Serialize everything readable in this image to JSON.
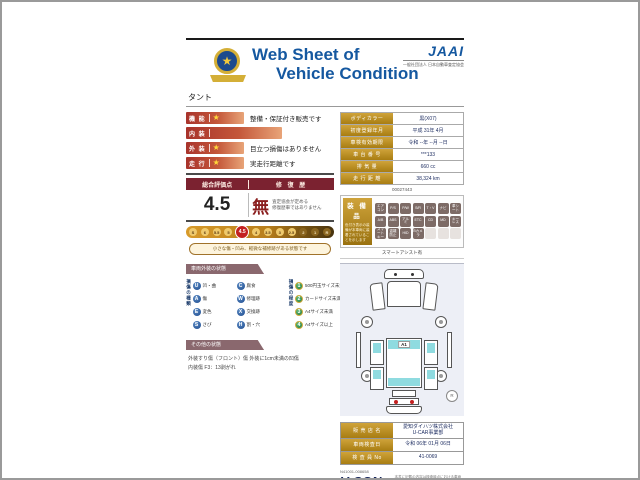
{
  "header": {
    "title_line1": "Web Sheet of",
    "title_line2": "Vehicle Condition",
    "brand": "JAAI",
    "brand_sub": "一般社団法人 日本自動車査定協会",
    "model": "タント"
  },
  "ratings": [
    {
      "label": "機 能",
      "star": true,
      "wide": false,
      "desc": "整備・保証付き販売です"
    },
    {
      "label": "内 装",
      "star": false,
      "wide": true,
      "desc": ""
    },
    {
      "label": "外 装",
      "star": true,
      "wide": false,
      "desc": "目立つ損傷はありません"
    },
    {
      "label": "走 行",
      "star": true,
      "wide": false,
      "desc": "実走行距離です"
    }
  ],
  "score": {
    "header_left": "総合評価点",
    "header_right": "修 復 歴",
    "value": "4.5",
    "repair": "無",
    "repair_note1": "査定協会が定める",
    "repair_note2": "修復歴車ではありません",
    "scale": [
      "S",
      "6",
      "5.5",
      "5",
      "4.5",
      "4",
      "3.5",
      "3",
      "2.5",
      "2",
      "1",
      "R"
    ],
    "scale_selected": "4.5",
    "scale_note": "小さな傷・凹み、軽微な補修跡がある状態です"
  },
  "vehicle_info": {
    "rows": [
      {
        "label": "ボディカラー",
        "value": "黒(X07)"
      },
      {
        "label": "初度登録年月",
        "value": "平成 31年 4月"
      },
      {
        "label": "車検有効期限",
        "value": "令和 --年 --月 --日"
      },
      {
        "label": "車 台 番 号",
        "value": "***133"
      },
      {
        "label": "排  気  量",
        "value": "660 cc"
      },
      {
        "label": "走 行 距 離",
        "value": "38,324 km"
      }
    ],
    "ref_no": "00027443"
  },
  "equipment": {
    "title": "装 備 品",
    "note": "色付き表示の装備が本車両に装着されていることを示します",
    "footer": "スマートアシスト有",
    "items": [
      {
        "label": "エアコン",
        "active": true
      },
      {
        "label": "P/S",
        "active": true
      },
      {
        "label": "P/W",
        "active": true
      },
      {
        "label": "S/R",
        "active": true
      },
      {
        "label": "T・V",
        "active": true
      },
      {
        "label": "ナビ",
        "active": true
      },
      {
        "label": "革シート",
        "active": true
      },
      {
        "label": "A/B",
        "active": true
      },
      {
        "label": "ABS",
        "active": true
      },
      {
        "label": "アルミ",
        "active": true
      },
      {
        "label": "ETC",
        "active": true
      },
      {
        "label": "CD",
        "active": true
      },
      {
        "label": "MD",
        "active": true
      },
      {
        "label": "キーレス",
        "active": true
      },
      {
        "label": "スマートキー",
        "active": true
      },
      {
        "label": "盗難防止",
        "active": true
      },
      {
        "label": "HID",
        "active": true
      },
      {
        "label": "Bカメラ",
        "active": true
      },
      {
        "label": "",
        "active": false
      },
      {
        "label": "",
        "active": false
      },
      {
        "label": "",
        "active": false
      }
    ]
  },
  "exterior_legend": {
    "section_title": "車両外装の状態",
    "type_title": "損傷の種類",
    "types": [
      {
        "code": "U",
        "label": "凹・曲"
      },
      {
        "code": "C",
        "label": "腐食"
      },
      {
        "code": "A",
        "label": "傷"
      },
      {
        "code": "W",
        "label": "修理跡"
      },
      {
        "code": "E",
        "label": "変色"
      },
      {
        "code": "X",
        "label": "交換跡"
      },
      {
        "code": "S",
        "label": "さび"
      },
      {
        "code": "H",
        "label": "割・穴"
      }
    ],
    "degree_title": "損傷の程度",
    "degrees": [
      {
        "code": "1",
        "label": "500円玉サイズ未満"
      },
      {
        "code": "2",
        "label": "カードサイズ未満"
      },
      {
        "code": "3",
        "label": "A4サイズ未満"
      },
      {
        "code": "4",
        "label": "A4サイズ以上"
      }
    ]
  },
  "other_condition": {
    "section_title": "その他の状態",
    "lines": [
      "外装すり傷（フロント）傷 外装に1cm未満の凹傷",
      "内装傷 F3：13剥がれ"
    ]
  },
  "diagram": {
    "marker": "A1",
    "corner_mark": "R"
  },
  "dealer": {
    "rows": [
      {
        "label": "販 売 店 名",
        "value": "愛知ダイハツ株式会社",
        "value2": "U-CAR事業部"
      },
      {
        "label": "車両検査日",
        "value": "令和 06年 01月 06日",
        "value2": ""
      },
      {
        "label": "検 査 員 No",
        "value": "41-0069",
        "value2": ""
      }
    ]
  },
  "footer": {
    "serial": "N41001-008658",
    "logo": "V-CON",
    "logo_sub": "Vehicle Condition Check System",
    "disclaimer": "本書に記載の内容は検査時点における車両の状態を示すものです。その後の使用・保管状況により状態が変化する場合があります。内容は車両状態の理解を補助するための簡略表示です。"
  },
  "colors": {
    "title_blue": "#1558a0",
    "maroon": "#7b2230",
    "rating_bar_red": "#a8332b",
    "gold": "#b8860b",
    "scale_highlight_red": "#c32020",
    "legend_blue": "#1c4a8e",
    "legend_green": "#1f7a3e",
    "window_cyan": "#8fdbe0",
    "navy_text": "#1a2a5e"
  }
}
